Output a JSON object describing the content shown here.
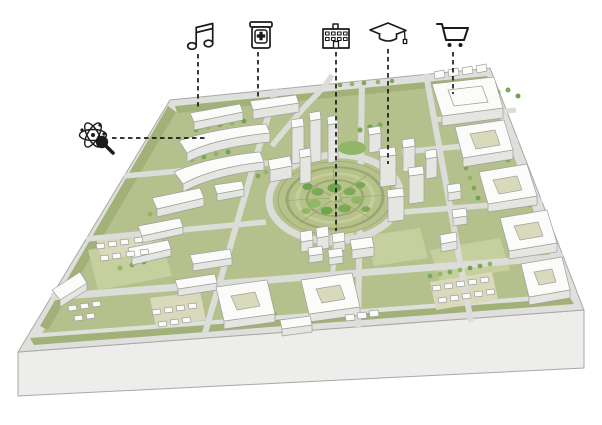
{
  "figure": {
    "kind": "3d-city-district-map-with-amenity-markers",
    "canvas": {
      "width": 602,
      "height": 425
    },
    "description_elements": [
      "base-slab",
      "street-grid",
      "green-blocks",
      "white-buildings",
      "central-circular-park",
      "amenity-icons-with-dashed-leader-lines"
    ]
  },
  "palette": {
    "bg": "#ffffff",
    "ink": "#1a1a1a",
    "road": "#dfe0dd",
    "road-light": "#dcddd8",
    "slab-front": "#ededeb",
    "slab-edge": "#a8a8a5",
    "green": "#b5c18c",
    "verge": "#a2b178",
    "lawn": "#c6cf9e",
    "court": "#d9dabb",
    "b-top": "#fbfbfa",
    "b-side": "#e5e5e1",
    "edge": "#a0a09c",
    "tree1": "#7da957",
    "tree2": "#8fb765",
    "tree3": "#6da44e",
    "park-path": "#9aa673",
    "park-light": "#c5cd9b",
    "park-lawn": "#b7c28b"
  },
  "markers": [
    {
      "id": "research",
      "icon": "atom-magnifier-icon",
      "meaning": "science-research",
      "x": 93,
      "y": 135,
      "line": {
        "x1": 112,
        "y1": 138,
        "x2": 205,
        "y2": 138
      }
    },
    {
      "id": "music",
      "icon": "music-note-icon",
      "meaning": "music-culture",
      "x": 200,
      "y": 37,
      "line": {
        "x1": 198,
        "y1": 54,
        "x2": 198,
        "y2": 110
      }
    },
    {
      "id": "pharmacy",
      "icon": "medicine-jar-icon",
      "meaning": "pharmacy-health",
      "x": 261,
      "y": 35,
      "line": {
        "x1": 258,
        "y1": 52,
        "x2": 258,
        "y2": 97
      }
    },
    {
      "id": "hospital",
      "icon": "civic-building-icon",
      "meaning": "public-institution",
      "x": 336,
      "y": 36,
      "line": {
        "x1": 336,
        "y1": 52,
        "x2": 336,
        "y2": 231
      }
    },
    {
      "id": "education",
      "icon": "graduation-cap-icon",
      "meaning": "education",
      "x": 388,
      "y": 32,
      "line": {
        "x1": 388,
        "y1": 49,
        "x2": 388,
        "y2": 164
      }
    },
    {
      "id": "shopping",
      "icon": "shopping-cart-icon",
      "meaning": "retail-shopping",
      "x": 453,
      "y": 34,
      "line": {
        "x1": 453,
        "y1": 52,
        "x2": 453,
        "y2": 94
      }
    }
  ]
}
